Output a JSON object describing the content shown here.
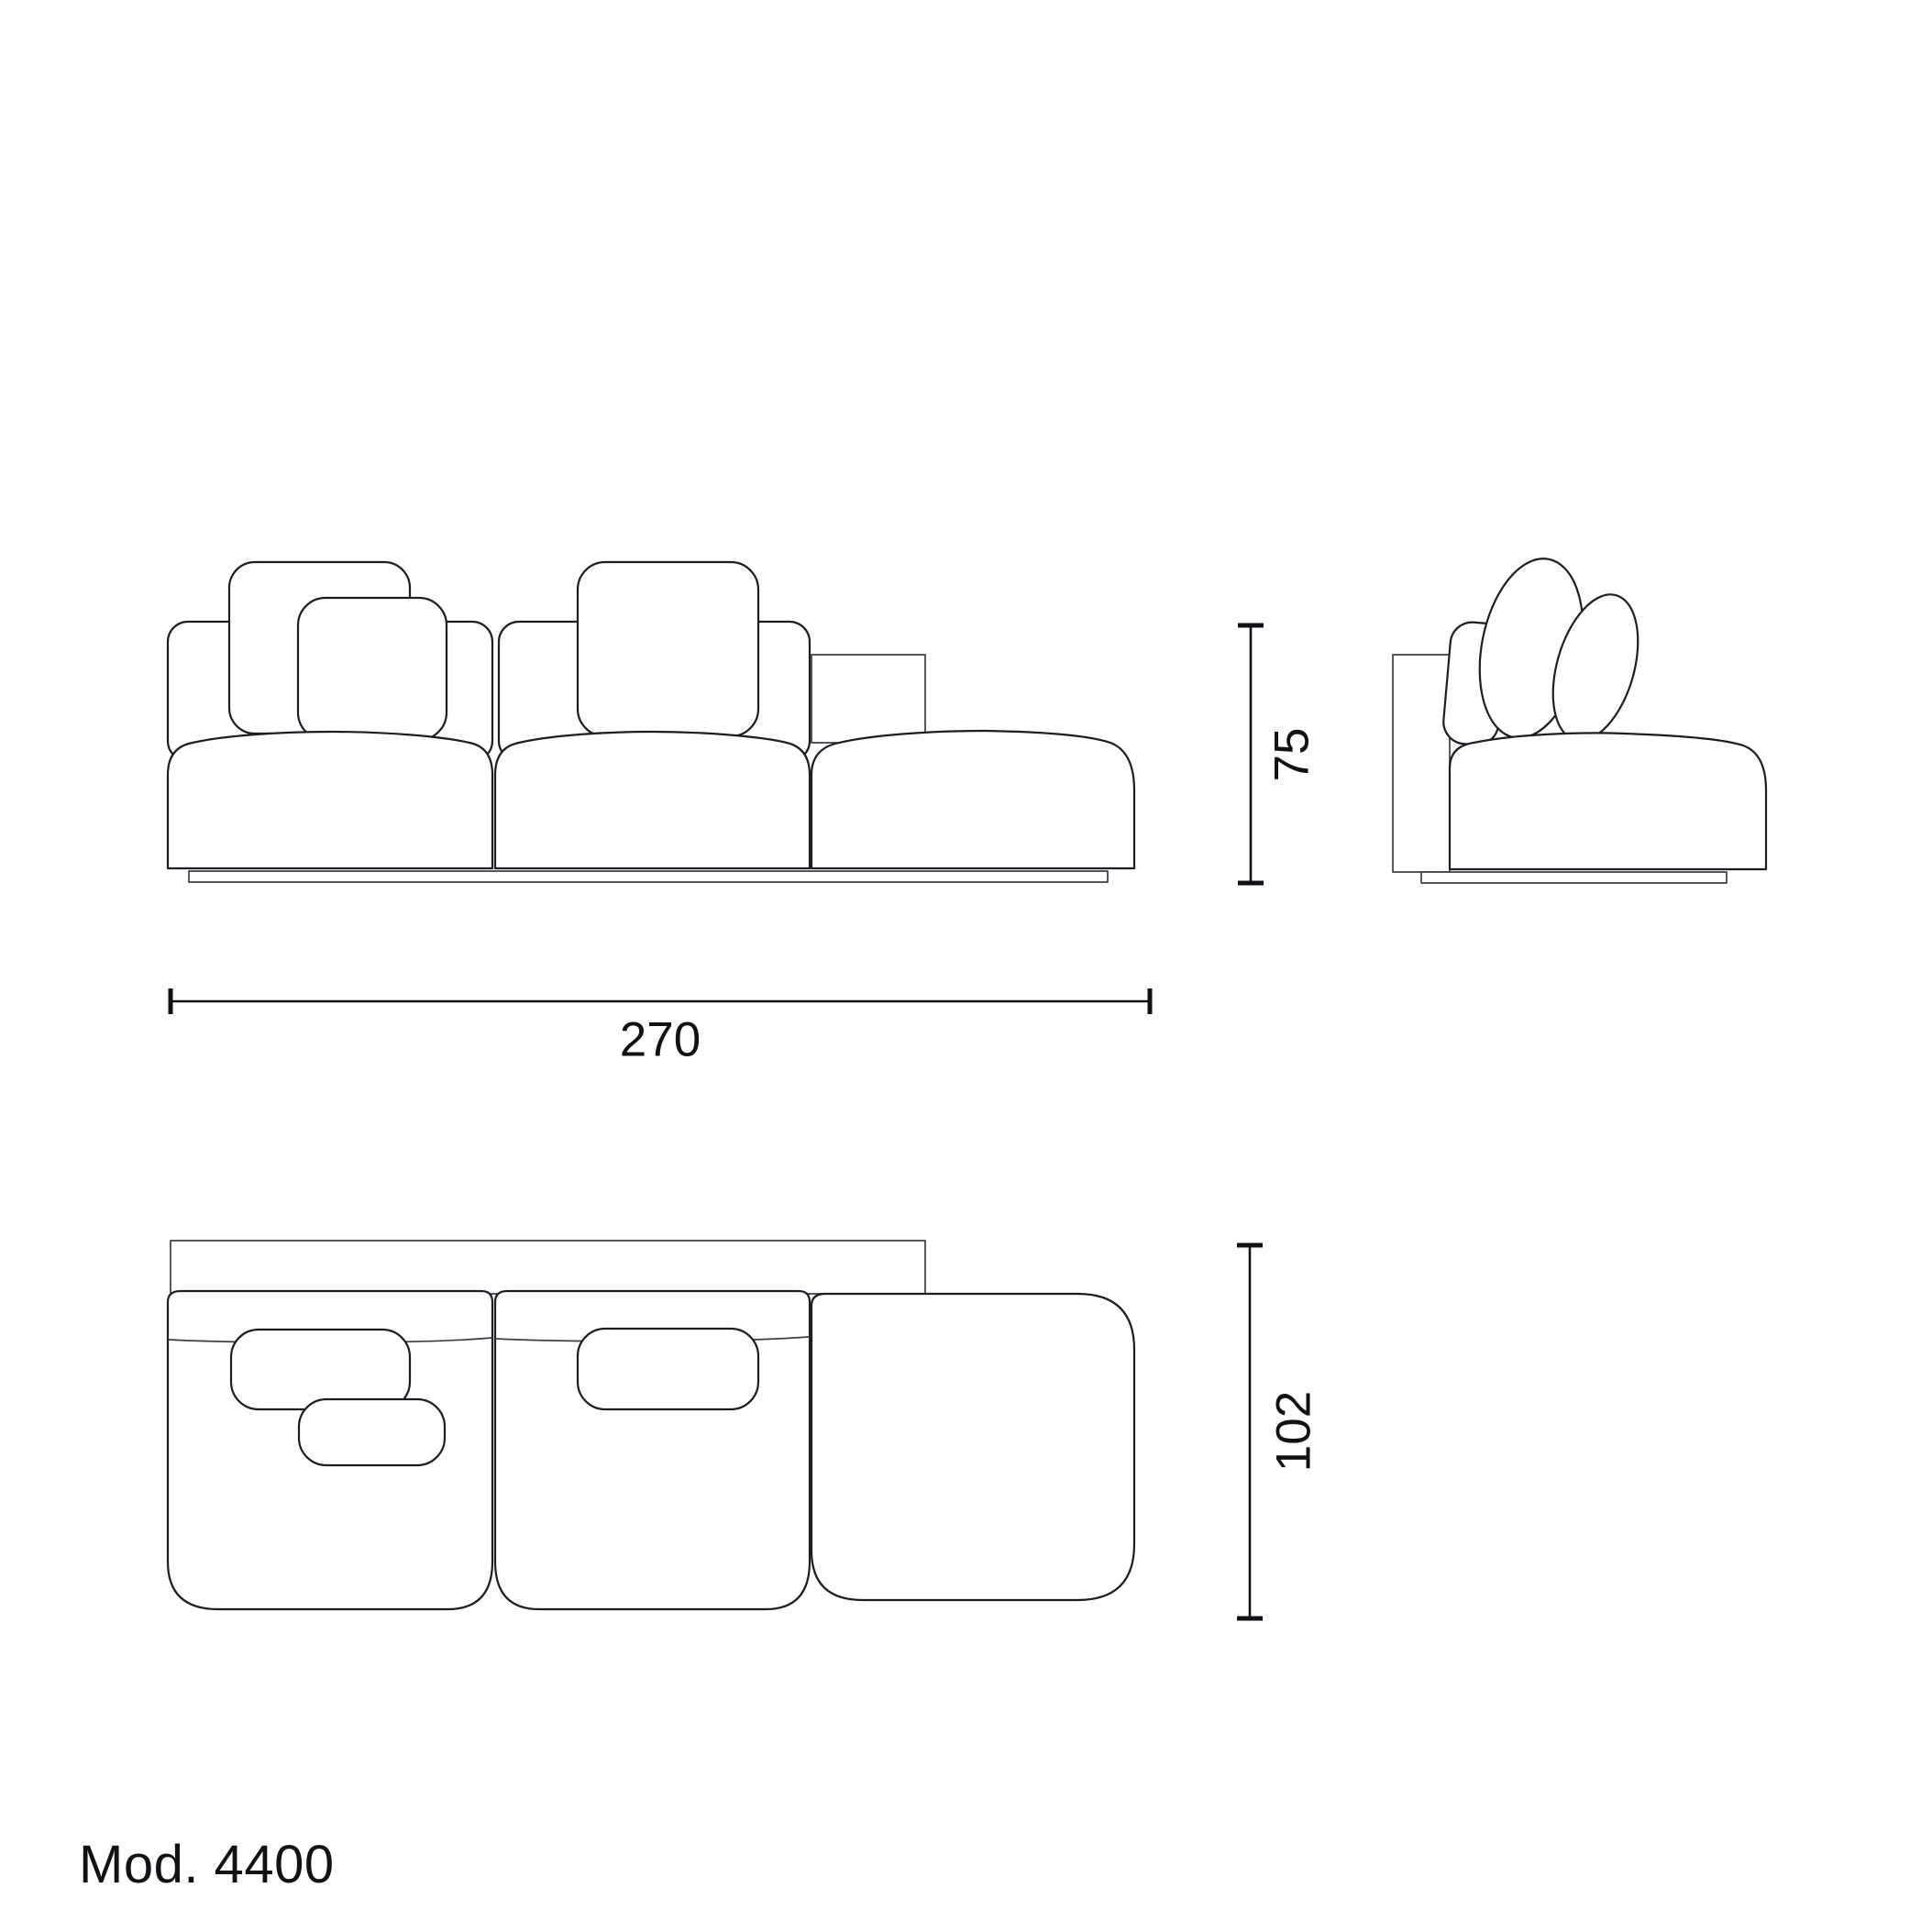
{
  "drawing": {
    "model_label": "Mod. 4400",
    "line_color": "#1d1d24",
    "dim_color": "#121216",
    "background_color": "#ffffff",
    "views": {
      "front": {
        "label": "front-elevation-view"
      },
      "side": {
        "label": "side-elevation-view"
      },
      "plan": {
        "label": "top-plan-view"
      }
    },
    "dimensions": {
      "width": {
        "value": "270",
        "orientation": "horizontal"
      },
      "height": {
        "value": "75",
        "orientation": "vertical"
      },
      "depth": {
        "value": "102",
        "orientation": "vertical"
      }
    }
  }
}
